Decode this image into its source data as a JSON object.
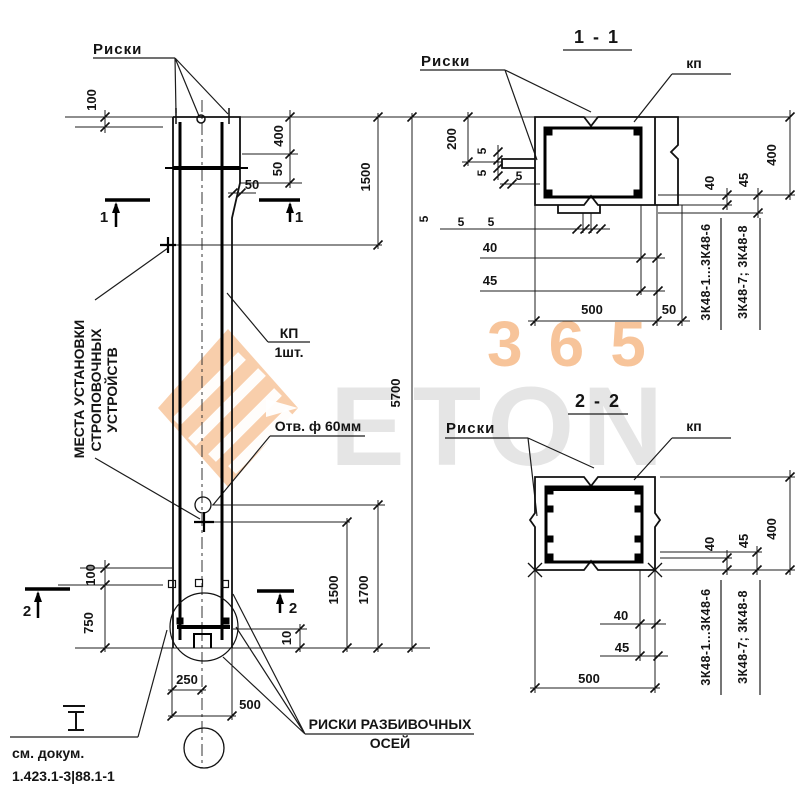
{
  "watermark": {
    "digits": "365",
    "word": "ETON"
  },
  "elevation": {
    "riski_top": "Риски",
    "mesta_line1": "МЕСТА УСТАНОВКИ",
    "mesta_line2": "СТРОПОВОЧНЫХ",
    "mesta_line3": "УСТРОЙСТВ",
    "kp_label": "КП",
    "kp_qty": "1шт.",
    "hole_label": "Отв. ф 60мм",
    "axes_label_line1": "РИСКИ РАЗБИВОЧНЫХ",
    "axes_label_line2": "ОСЕЙ",
    "see_doc_line1": "см. докум.",
    "see_doc_line2": "1.423.1-3|88.1-1",
    "section1_mark": "1",
    "section2_mark": "2",
    "dims": {
      "top_offset": "100",
      "console_height": "400",
      "console_v": "50",
      "console_h": "50",
      "top_to_strop": "1500",
      "total": "5700",
      "strop_bottom": "1500",
      "hole_bottom": "1700",
      "risk_offset": "100",
      "foot": "750",
      "edge": "10",
      "half_width": "250",
      "width": "500"
    }
  },
  "section_1_1": {
    "title": "1 - 1",
    "riski": "Риски",
    "kp": "кп",
    "mark_a": "3К48-1...3К48-6",
    "mark_b": "3К48-7; 3К48-8",
    "dims": {
      "left": "200",
      "t5a": "5",
      "t5b": "5",
      "t5c": "5",
      "b5a": "5",
      "b5b": "5",
      "b5c": "5",
      "cover40": "40",
      "cover45": "45",
      "width": "500",
      "console": "50",
      "r40": "40",
      "r45": "45",
      "height": "400"
    }
  },
  "section_2_2": {
    "title": "2 - 2",
    "riski": "Риски",
    "kp": "кп",
    "mark_a": "3К48-1...3К48-6",
    "mark_b": "3К48-7; 3К48-8",
    "dims": {
      "cover40": "40",
      "cover45": "45",
      "width": "500",
      "r40": "40",
      "r45": "45",
      "height": "400"
    }
  }
}
